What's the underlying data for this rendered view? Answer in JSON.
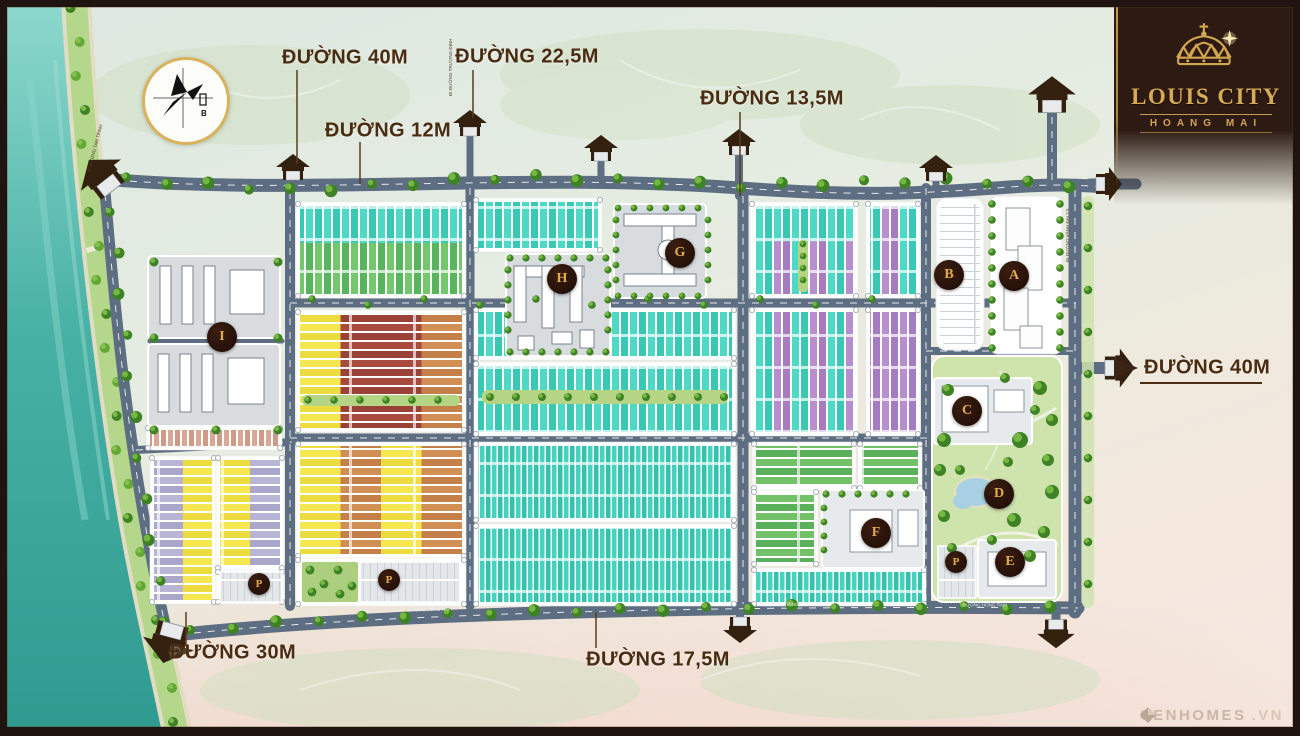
{
  "branding": {
    "title": "LOUIS CITY",
    "subtitle": "HOANG MAI"
  },
  "compass": {
    "north_label": "B"
  },
  "road_labels": {
    "top_40": "ĐƯỜNG 40M",
    "top_22_5": "ĐƯỜNG 22,5M",
    "top_12": "ĐƯỜNG 12M",
    "top_13_5": "ĐƯỜNG 13,5M",
    "right_40": "ĐƯỜNG 40M",
    "bottom_30": "ĐƯỜNG 30M",
    "bottom_17_5": "ĐƯỜNG 17,5M"
  },
  "street_names": {
    "bottom": "ĐƯỜNG HỒNG TÍNH",
    "left": "ĐI ĐƯỜNG TAM TRINH",
    "top_access": "ĐI ĐƯỜNG TRƯƠNG ĐỊNH",
    "right": "ĐI ĐƯỜNG VÀNH ĐAI 2.5"
  },
  "zones": {
    "a": "A",
    "b": "B",
    "c": "C",
    "d": "D",
    "e": "E",
    "f": "F",
    "g": "G",
    "h": "H",
    "i": "I",
    "p": "P"
  },
  "watermark": {
    "brand": "CENHOMES",
    "domain": ".VN"
  },
  "colors": {
    "water": "#54bcb0",
    "road": "#5d6e82",
    "label_text": "#4a2c12",
    "accent_gold": "#d6ab55",
    "panel_bg": "#2c1a13",
    "lot_teal": "#4ed9c6",
    "lot_green": "#58b55e",
    "lot_yellow": "#f4e74f",
    "lot_maroon": "#a84a3d",
    "lot_orange": "#d18e55",
    "lot_purple": "#b78fce",
    "lot_lavender": "#aaa7ca",
    "lot_pink": "#d9a795"
  }
}
